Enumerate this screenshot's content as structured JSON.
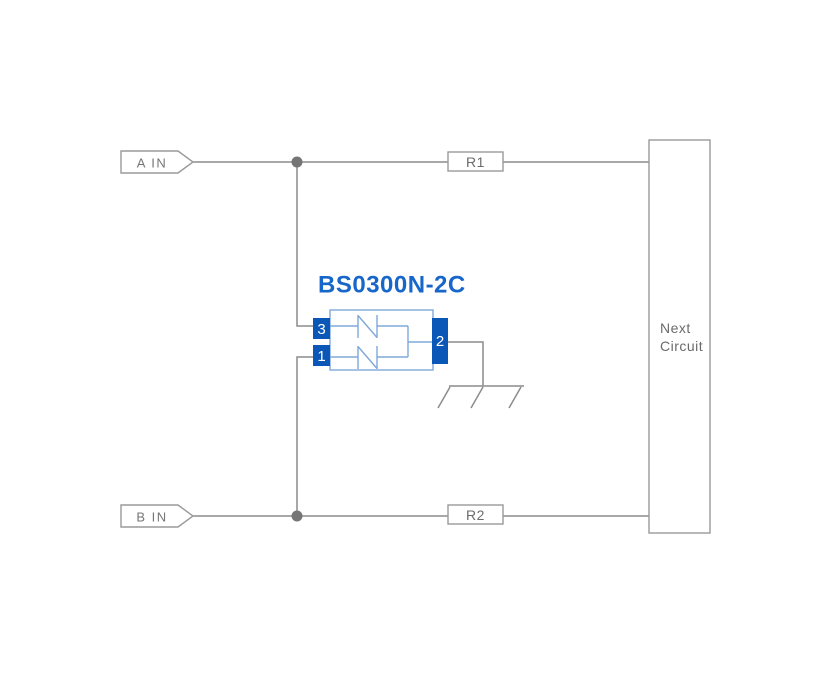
{
  "diagram": {
    "component": {
      "title": "BS0300N-2C",
      "pin_top_left": "3",
      "pin_bottom_left": "1",
      "pin_right": "2"
    },
    "inputs": {
      "a": "A IN",
      "b": "B IN"
    },
    "resistors": {
      "r1": "R1",
      "r2": "R2"
    },
    "next_circuit": {
      "line1": "Next",
      "line2": "Circuit"
    },
    "icons": {
      "junction": "junction-dot-icon",
      "ground": "ground-icon",
      "diode": "tvs-diode-icon",
      "input_tag": "input-arrow-tag-icon"
    },
    "colors": {
      "label_blue": "#1766c9",
      "pin_blue": "#0b57b7",
      "component_outline_blue": "#7fa8d9",
      "wire_gray": "#8c8c8c",
      "box_border_gray": "#9a9a9a",
      "text_gray": "#6b6b6b",
      "junction_dot_gray": "#757575",
      "background": "#ffffff"
    }
  }
}
